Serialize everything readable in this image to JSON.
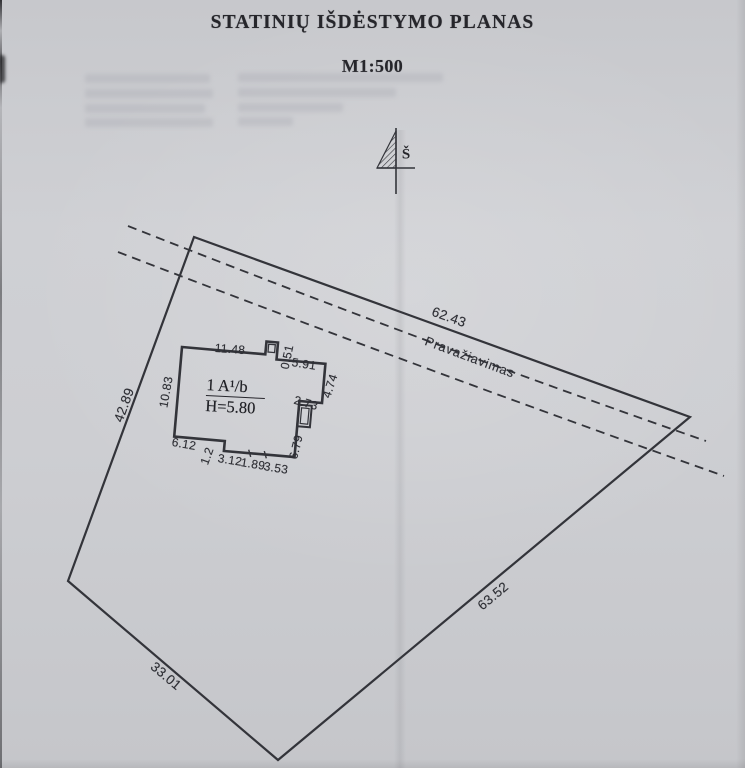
{
  "page": {
    "title": "STATINIŲ IŠDĖSTYMO PLANAS",
    "scale": "M1:500"
  },
  "north_arrow": {
    "label": "Š"
  },
  "road": {
    "label": "Pravažiavimas"
  },
  "plot": {
    "edge_top": "62.43",
    "edge_right": "63.52",
    "edge_bottom": "33.01",
    "edge_left": "42.89"
  },
  "building": {
    "label": "1 A¹/b",
    "height": "H=5.80",
    "dims": {
      "top": "11.48",
      "step_top": "0.51",
      "top_right": "5.91",
      "left": "10.83",
      "right_upper": "4.74",
      "right_step": "2.73",
      "right_lower": "6.79",
      "bottom_left": "6.12",
      "bottom_step": "1.2",
      "bottom_mid1": "3.12",
      "bottom_mid2": "1.89",
      "bottom_mid3": "3.53"
    }
  },
  "colors": {
    "paper": "#cbccd0",
    "ink": "#33343a",
    "text": "#26262b",
    "dim": "#2e2f35",
    "ghost": "#a9aab2"
  }
}
